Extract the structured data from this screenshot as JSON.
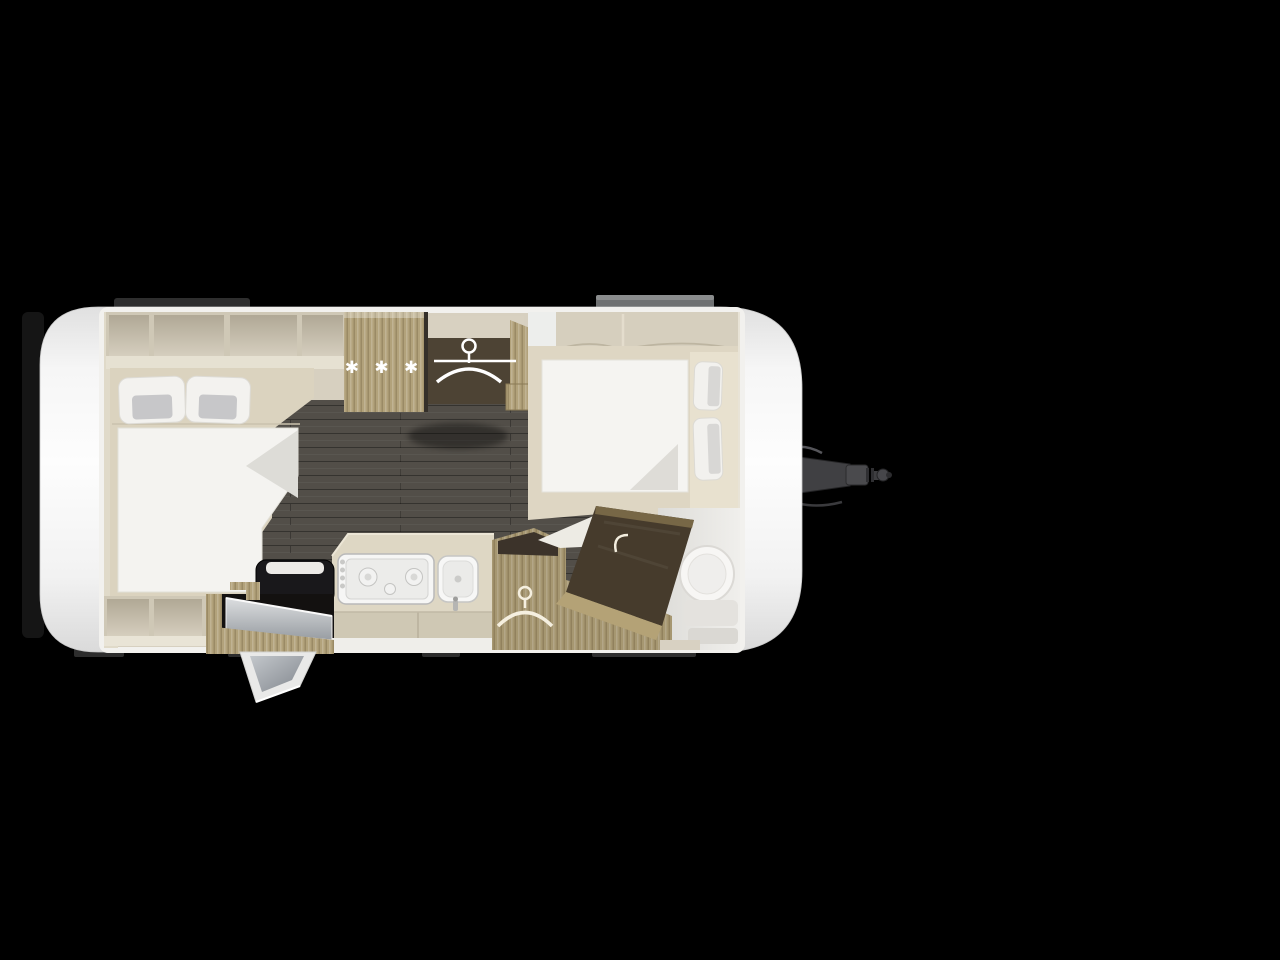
{
  "scene": {
    "description": "Top-down 3D rendered caravan floor plan on black background",
    "background_color": "#000000",
    "body_color": "#f6f6f6",
    "floor_color": "#5c5751",
    "wood_color": "#b2a27b",
    "dark_wood_color": "#463b2c",
    "accent_white": "#f4f3f0"
  },
  "icons": {
    "freezer_stars": {
      "glyph": "✱ ✱ ✱",
      "meaning": "fridge-freezer star symbol",
      "color": "#ffffff"
    },
    "hanger_rear": {
      "meaning": "clothes-hanger icon in rear wardrobe",
      "color": "#ffffff"
    },
    "hanger_front": {
      "meaning": "clothes-hanger icon in front wardrobe",
      "color": "#f5efdf"
    }
  },
  "features": {
    "rear_bed": "double bed with two pillows and duvet (rear, left)",
    "front_bed": "french bed with two pillows and duvet (front, right)",
    "fridge": "fridge-freezer cabinet marked with freezer stars",
    "wardrobe_rear": "wardrobe with hanger rail (top centre)",
    "wardrobe_front": "wardrobe with hanger (bottom centre)",
    "kitchen": "kitchen block with 3-burner hob and sink",
    "bench_seat": "dark bench seat beside entrance",
    "entrance_door": "entrance door shown swung open (bottom)",
    "bathroom": "washroom with toilet (front right)",
    "bathroom_door": "diagonal washroom door with handle",
    "tow_hitch": "A-frame drawbar with coupling head (front, right)",
    "overhead_lockers": "overhead storage lockers along the walls"
  }
}
